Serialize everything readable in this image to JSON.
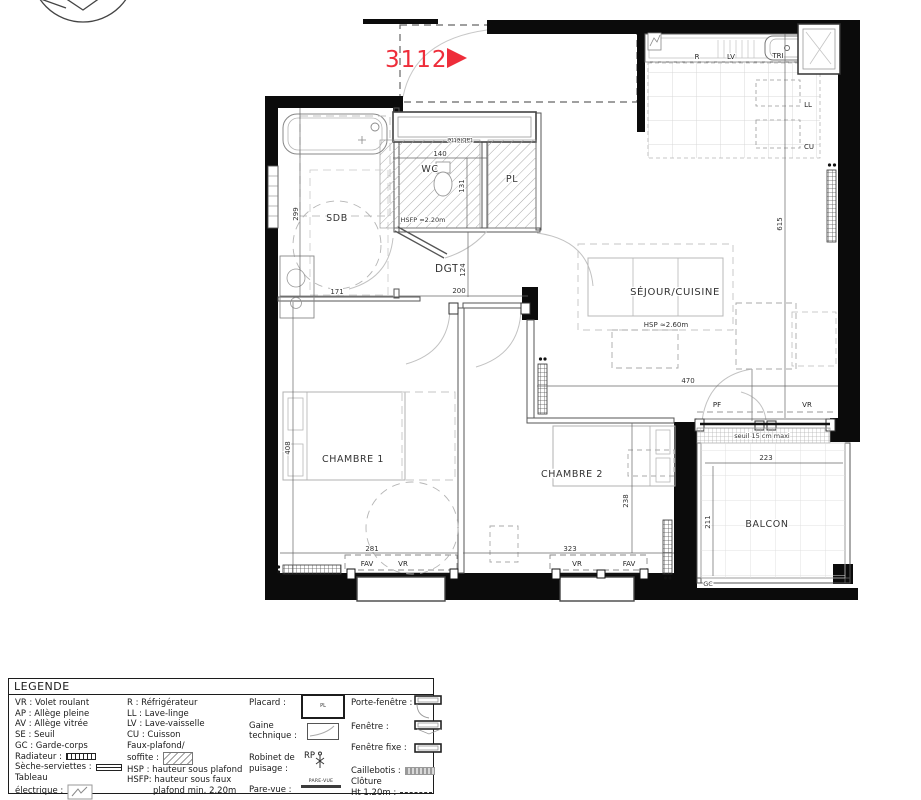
{
  "plan": {
    "unit": {
      "number": "3112"
    },
    "rooms": {
      "sdb": "SDB",
      "wc": "WC",
      "pl": "PL",
      "dgt": "DGT",
      "sejour": "SÉJOUR/CUISINE",
      "chambre1": "CHAMBRE 1",
      "chambre2": "CHAMBRE 2",
      "balcon": "BALCON"
    },
    "notes": {
      "hsfp": "HSFP ≈2.20m",
      "hsp": "HSP ≈2.60m",
      "tablette": "tablette",
      "seuil": "seuil 15 cm maxi",
      "gc": "GC"
    },
    "appliances": {
      "r": "R",
      "lv": "LV",
      "tri": "TRI",
      "ll": "LL",
      "cu": "CU"
    },
    "openings": {
      "pf": "PF",
      "vr_sejour": "VR",
      "fav_ch1": "FAV",
      "vr_ch1": "VR",
      "vr_ch2": "VR",
      "fav_ch2": "FAV"
    },
    "dims": {
      "sdb_h": "299",
      "sdb_w": "171",
      "wc_w": "140",
      "wc_h": "131",
      "dgt_h": "124",
      "dgt_w": "200",
      "sejour_w": "470",
      "sejour_h": "615",
      "ch1_h": "408",
      "ch1_w": "281",
      "ch2_w": "323",
      "ch2_h": "238",
      "balcon_w": "223",
      "balcon_h": "211"
    },
    "colors": {
      "accent_red": "#ee2d3a"
    }
  },
  "legend": {
    "title": "LEGENDE",
    "col1": [
      "VR : Volet roulant",
      "AP : Allège pleine",
      "AV : Allège vitrée",
      "SE : Seuil",
      "GC : Garde-corps",
      "Radiateur :",
      "Sèche-serviettes :",
      "Tableau",
      "électrique :"
    ],
    "col2": [
      "R : Réfrigérateur",
      "LL : Lave-linge",
      "LV : Lave-vaisselle",
      "CU : Cuisson",
      "Faux-plafond/",
      "soffite :",
      "HSP : hauteur sous plafond",
      "HSFP: hauteur sous faux",
      "plafond min. 2.20m"
    ],
    "col3": [
      "Placard :",
      "Gaine",
      "technique :",
      "Robinet de",
      "puisage :",
      "Pare-vue :"
    ],
    "col4": [
      "Porte-fenêtre :",
      "Fenêtre :",
      "Fenêtre fixe :",
      "Caillebotis :",
      "Clôture",
      "Ht 1.20m :"
    ],
    "placard_icon_label": "PL",
    "rp_label": "RP",
    "pare_vue_label": "PARE-VUE"
  }
}
